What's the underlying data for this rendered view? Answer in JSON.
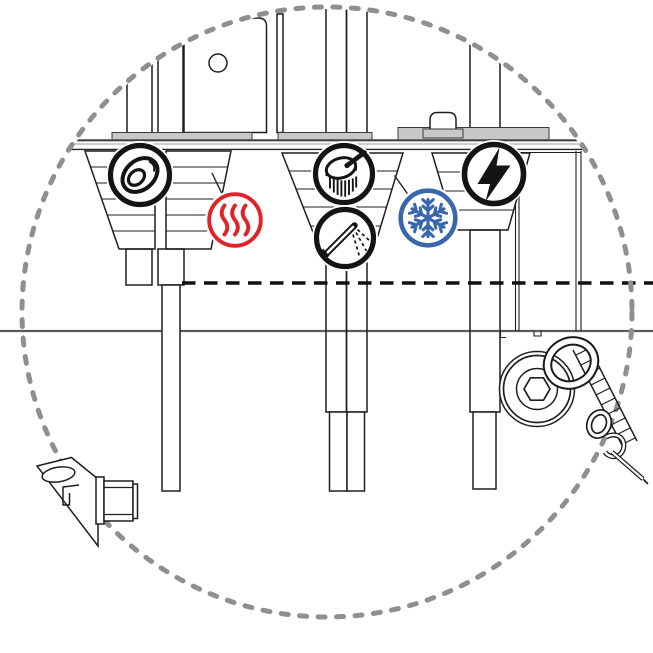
{
  "diagram": {
    "kind": "faucet-installation-detail-view",
    "view": "magnified dashed detail circle showing under-sink hose connections"
  },
  "colors": {
    "hot_red": "#E12229",
    "cold_blue": "#3A66AE",
    "line_black": "#141414",
    "detail_circle_gray": "#8F8F8F",
    "hose_fill_gray": "#D7D7D7"
  },
  "icons": [
    {
      "name": "o-ring-icon",
      "meaning": "o-ring / gasket on left faucet shank"
    },
    {
      "name": "hot-water-icon",
      "meaning": "hot water supply (red heat waves)"
    },
    {
      "name": "brush-icon",
      "meaning": "round brush / aerator head"
    },
    {
      "name": "spray-hose-icon",
      "meaning": "pull-out spray wand"
    },
    {
      "name": "cold-water-icon",
      "meaning": "cold water supply (blue snowflake)"
    },
    {
      "name": "electricity-icon",
      "meaning": "electrical connection (lightning bolt)"
    }
  ]
}
